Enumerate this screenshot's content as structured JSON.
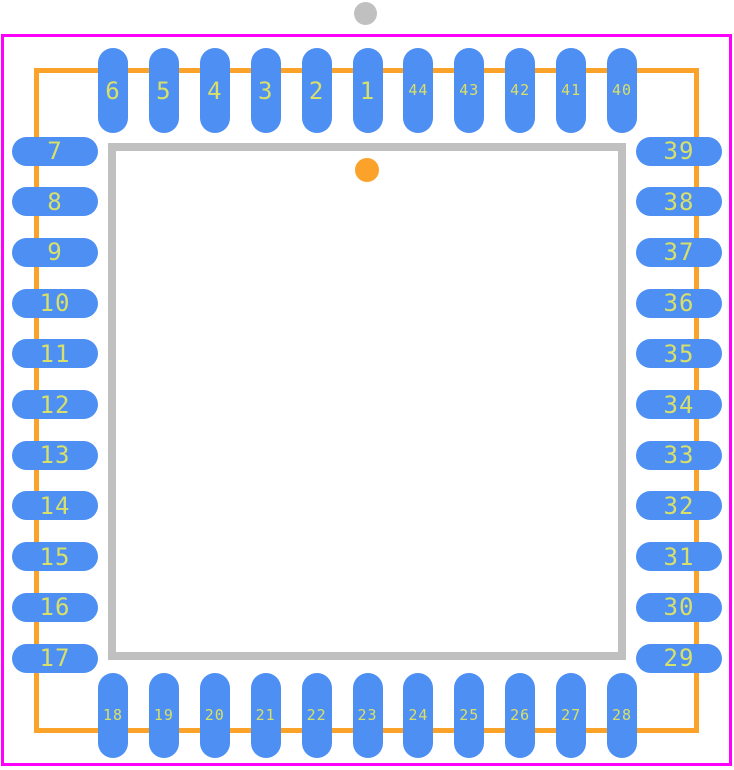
{
  "diagram": {
    "title": "PLCC-44 package footprint",
    "colors": {
      "background": "#ffffff",
      "page_border": "#ff00ff",
      "courtyard_outline": "#fba22b",
      "body_outline": "#c0c0c0",
      "origin_marker": "#c0c0c0",
      "pin1_marker": "#fba22b",
      "pad_fill": "#4d8ff2",
      "pad_number_text": "#d8e06a"
    },
    "pins": {
      "top": [
        {
          "label": "6",
          "text_size": "large"
        },
        {
          "label": "5",
          "text_size": "large"
        },
        {
          "label": "4",
          "text_size": "large"
        },
        {
          "label": "3",
          "text_size": "large"
        },
        {
          "label": "2",
          "text_size": "large"
        },
        {
          "label": "1",
          "text_size": "large"
        },
        {
          "label": "44",
          "text_size": "small"
        },
        {
          "label": "43",
          "text_size": "small"
        },
        {
          "label": "42",
          "text_size": "small"
        },
        {
          "label": "41",
          "text_size": "small"
        },
        {
          "label": "40",
          "text_size": "small"
        }
      ],
      "left": [
        {
          "label": "7",
          "text_size": "large"
        },
        {
          "label": "8",
          "text_size": "large"
        },
        {
          "label": "9",
          "text_size": "large"
        },
        {
          "label": "10",
          "text_size": "large"
        },
        {
          "label": "11",
          "text_size": "large"
        },
        {
          "label": "12",
          "text_size": "large"
        },
        {
          "label": "13",
          "text_size": "large"
        },
        {
          "label": "14",
          "text_size": "large"
        },
        {
          "label": "15",
          "text_size": "large"
        },
        {
          "label": "16",
          "text_size": "large"
        },
        {
          "label": "17",
          "text_size": "large"
        }
      ],
      "right": [
        {
          "label": "39",
          "text_size": "large"
        },
        {
          "label": "38",
          "text_size": "large"
        },
        {
          "label": "37",
          "text_size": "large"
        },
        {
          "label": "36",
          "text_size": "large"
        },
        {
          "label": "35",
          "text_size": "large"
        },
        {
          "label": "34",
          "text_size": "large"
        },
        {
          "label": "33",
          "text_size": "large"
        },
        {
          "label": "32",
          "text_size": "large"
        },
        {
          "label": "31",
          "text_size": "large"
        },
        {
          "label": "30",
          "text_size": "large"
        },
        {
          "label": "29",
          "text_size": "large"
        }
      ],
      "bottom": [
        {
          "label": "18",
          "text_size": "small"
        },
        {
          "label": "19",
          "text_size": "small"
        },
        {
          "label": "20",
          "text_size": "small"
        },
        {
          "label": "21",
          "text_size": "small"
        },
        {
          "label": "22",
          "text_size": "small"
        },
        {
          "label": "23",
          "text_size": "small"
        },
        {
          "label": "24",
          "text_size": "small"
        },
        {
          "label": "25",
          "text_size": "small"
        },
        {
          "label": "26",
          "text_size": "small"
        },
        {
          "label": "27",
          "text_size": "small"
        },
        {
          "label": "28",
          "text_size": "small"
        }
      ]
    }
  }
}
